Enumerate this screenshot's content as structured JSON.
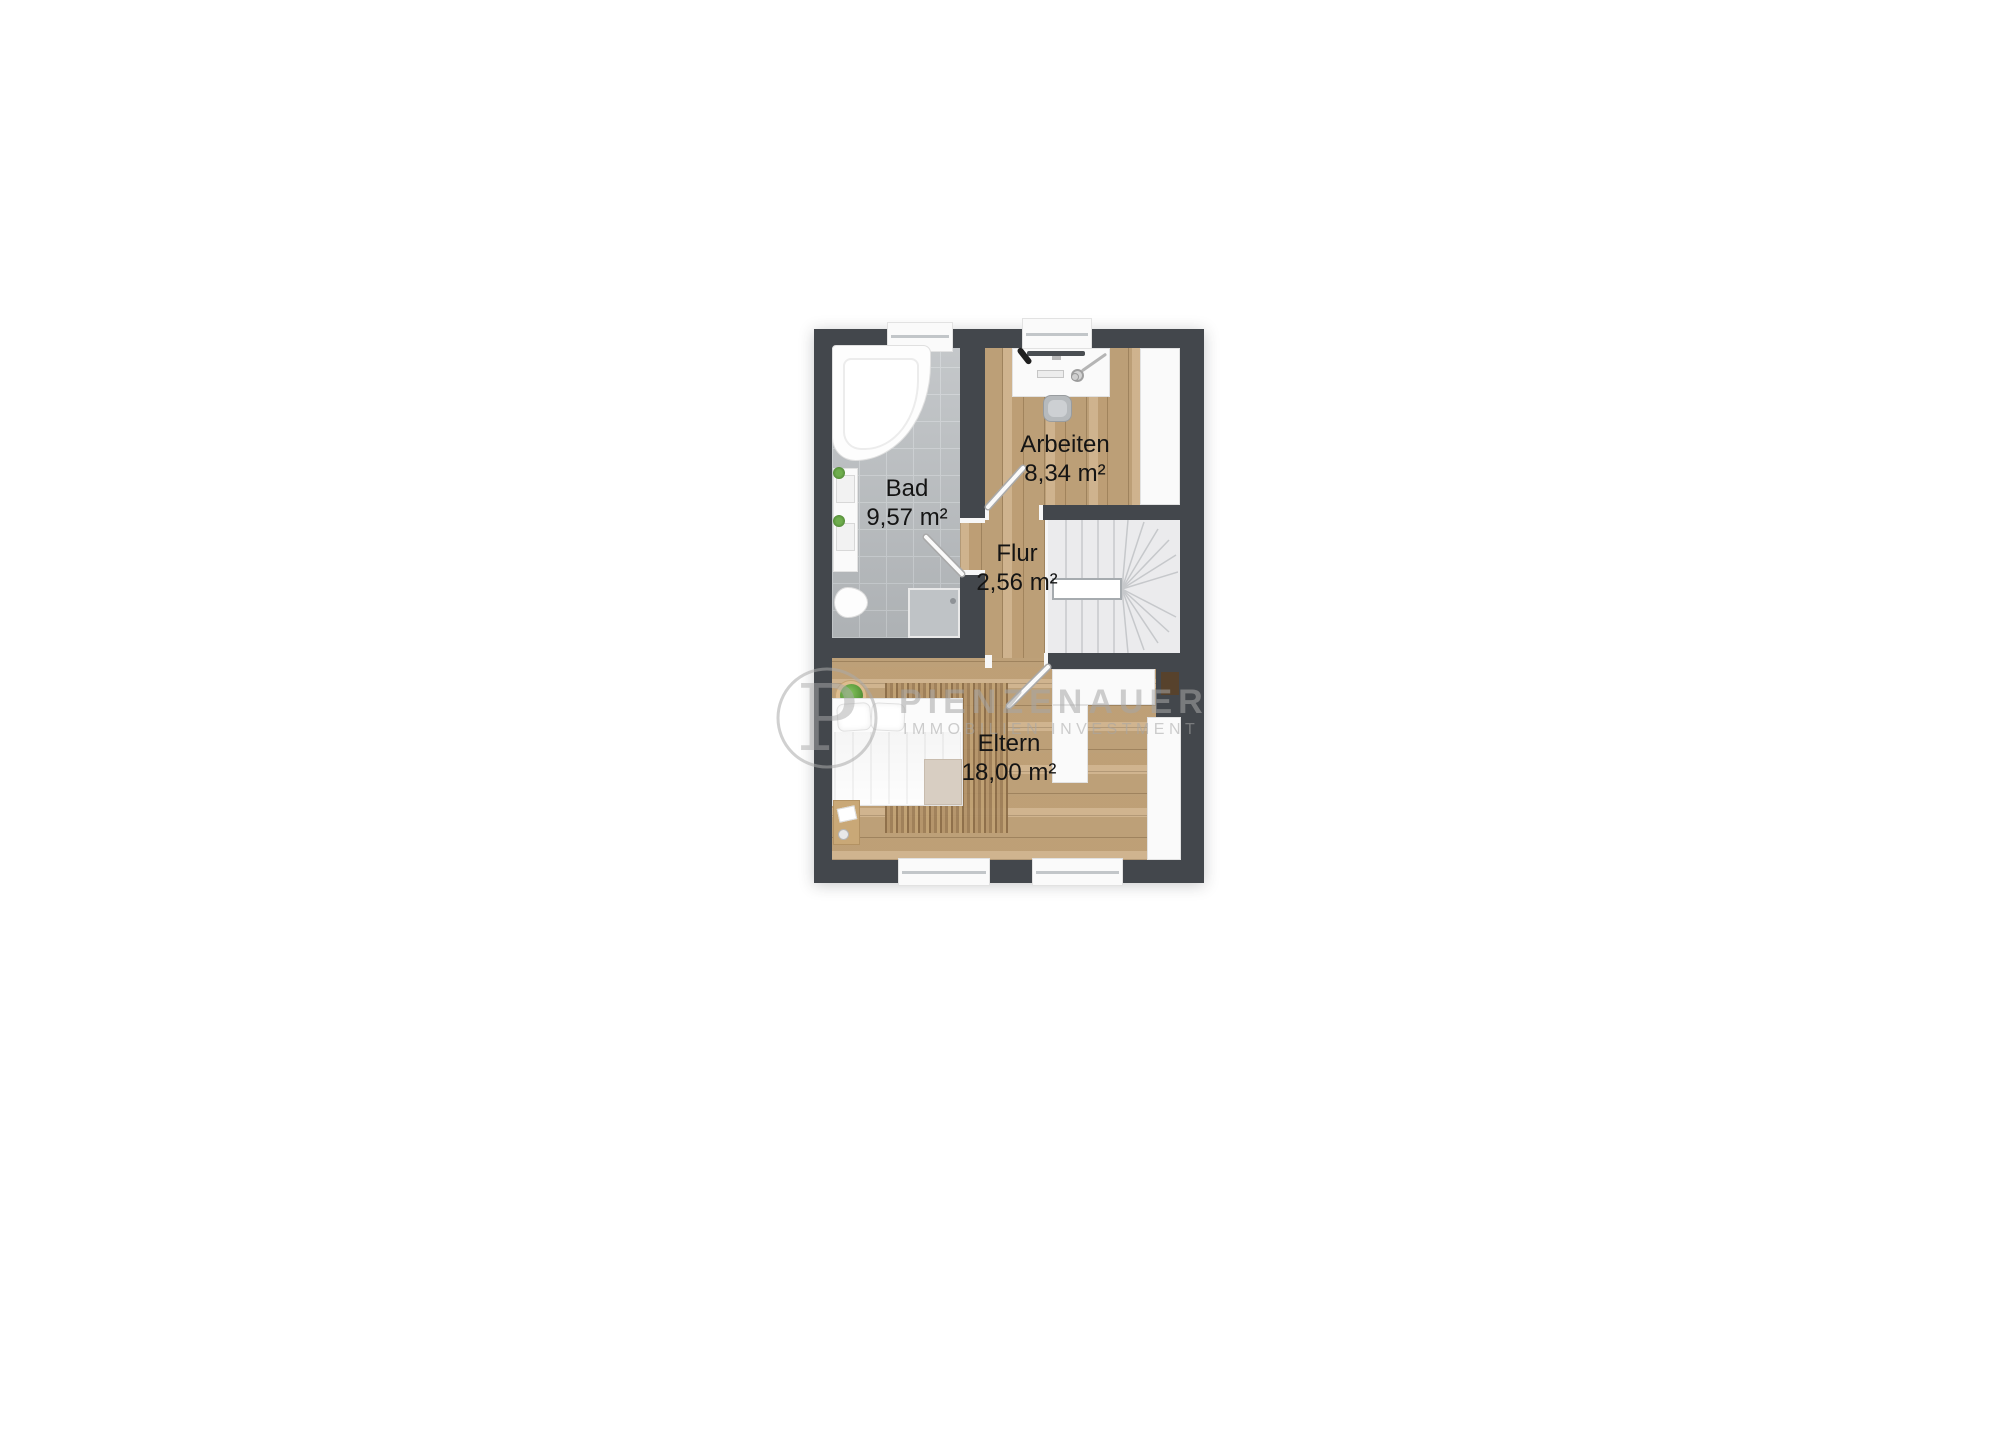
{
  "floorplan": {
    "title": "Obergeschoss Grundriss",
    "rooms": [
      {
        "name": "Bad",
        "area": "9,57 m²"
      },
      {
        "name": "Arbeiten",
        "area": "8,34 m²"
      },
      {
        "name": "Flur",
        "area": "2,56 m²"
      },
      {
        "name": "Eltern",
        "area": "18,00 m²"
      }
    ],
    "colors": {
      "wall": "#43474c",
      "wood_floor": "#c8a97e",
      "tile_floor": "#b7bbbe",
      "stairs": "#ebebed",
      "plant": "#5f9e3f"
    }
  },
  "watermark": {
    "monogram": "P",
    "brand": "PIENZENAUER",
    "tagline": "IMMOBILIEN INVESTMENT"
  }
}
